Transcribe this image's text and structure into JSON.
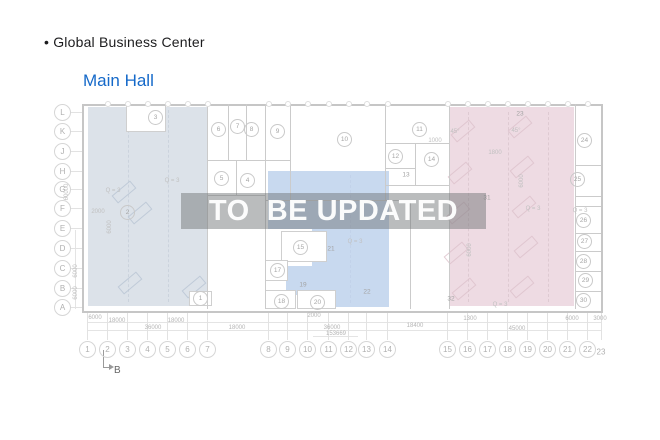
{
  "header": {
    "bullet": "•",
    "title": "Global Business Center",
    "subtitle": "Main Hall"
  },
  "watermark": {
    "text": "TO  BE UPDATED"
  },
  "colors": {
    "subtitle": "#1569c9",
    "region_left": "#dce2e9",
    "region_middle": "#c8d9ef",
    "region_right": "#eedbe3",
    "wall": "#cbcbcb",
    "annotation": "#c0c0c0"
  },
  "plan": {
    "row_labels": [
      {
        "t": "L",
        "y": 112
      },
      {
        "t": "K",
        "y": 131
      },
      {
        "t": "J",
        "y": 151
      },
      {
        "t": "H",
        "y": 171
      },
      {
        "t": "G",
        "y": 189
      },
      {
        "t": "F",
        "y": 208
      },
      {
        "t": "E",
        "y": 228
      },
      {
        "t": "D",
        "y": 248
      },
      {
        "t": "C",
        "y": 268
      },
      {
        "t": "B",
        "y": 288
      },
      {
        "t": "A",
        "y": 307
      }
    ],
    "col_labels": [
      {
        "t": "1",
        "x": 87
      },
      {
        "t": "2",
        "x": 107
      },
      {
        "t": "3",
        "x": 127
      },
      {
        "t": "4",
        "x": 147
      },
      {
        "t": "5",
        "x": 167
      },
      {
        "t": "6",
        "x": 187
      },
      {
        "t": "7",
        "x": 207
      },
      {
        "t": "8",
        "x": 268
      },
      {
        "t": "9",
        "x": 287
      },
      {
        "t": "10",
        "x": 307
      },
      {
        "t": "11",
        "x": 328
      },
      {
        "t": "12",
        "x": 348
      },
      {
        "t": "13",
        "x": 366
      },
      {
        "t": "14",
        "x": 387
      },
      {
        "t": "15",
        "x": 447
      },
      {
        "t": "16",
        "x": 467
      },
      {
        "t": "17",
        "x": 487
      },
      {
        "t": "18",
        "x": 507
      },
      {
        "t": "19",
        "x": 527
      },
      {
        "t": "20",
        "x": 547
      },
      {
        "t": "21",
        "x": 567
      },
      {
        "t": "22",
        "x": 587
      },
      {
        "t": "23",
        "x": 601,
        "y": 352,
        "plain": true
      }
    ],
    "rooms": [
      {
        "t": "3",
        "x": 155,
        "y": 117
      },
      {
        "t": "6",
        "x": 218,
        "y": 129
      },
      {
        "t": "7",
        "x": 237,
        "y": 126
      },
      {
        "t": "8",
        "x": 251,
        "y": 129
      },
      {
        "t": "9",
        "x": 277,
        "y": 131
      },
      {
        "t": "5",
        "x": 221,
        "y": 178
      },
      {
        "t": "4",
        "x": 247,
        "y": 180
      },
      {
        "t": "10",
        "x": 344,
        "y": 139
      },
      {
        "t": "11",
        "x": 419,
        "y": 129
      },
      {
        "t": "12",
        "x": 395,
        "y": 156
      },
      {
        "t": "14",
        "x": 431,
        "y": 159
      },
      {
        "t": "2",
        "x": 127,
        "y": 212
      },
      {
        "t": "1",
        "x": 200,
        "y": 298
      },
      {
        "t": "15",
        "x": 300,
        "y": 247
      },
      {
        "t": "17",
        "x": 277,
        "y": 270
      },
      {
        "t": "18",
        "x": 281,
        "y": 301
      },
      {
        "t": "20",
        "x": 317,
        "y": 302
      },
      {
        "t": "24",
        "x": 584,
        "y": 140
      },
      {
        "t": "25",
        "x": 577,
        "y": 179
      },
      {
        "t": "26",
        "x": 583,
        "y": 220
      },
      {
        "t": "27",
        "x": 584,
        "y": 241
      },
      {
        "t": "28",
        "x": 583,
        "y": 261
      },
      {
        "t": "29",
        "x": 585,
        "y": 280
      },
      {
        "t": "30",
        "x": 583,
        "y": 300
      },
      {
        "t": "13",
        "x": 406,
        "y": 175,
        "p": true
      },
      {
        "t": "19",
        "x": 303,
        "y": 285,
        "p": true
      },
      {
        "t": "21",
        "x": 331,
        "y": 249,
        "p": true
      },
      {
        "t": "22",
        "x": 367,
        "y": 292,
        "p": true
      },
      {
        "t": "23",
        "x": 520,
        "y": 114,
        "p": true
      },
      {
        "t": "31",
        "x": 487,
        "y": 198,
        "p": true
      },
      {
        "t": "32",
        "x": 451,
        "y": 299,
        "p": true
      }
    ],
    "annotations": [
      {
        "t": "Q = 3",
        "x": 113,
        "y": 191
      },
      {
        "t": "Q = 3",
        "x": 172,
        "y": 181
      },
      {
        "t": "2000",
        "x": 98,
        "y": 212
      },
      {
        "t": "6000",
        "x": 110,
        "y": 227,
        "rot": true
      },
      {
        "t": "Q = 3",
        "x": 355,
        "y": 242
      },
      {
        "t": "Q = 3",
        "x": 533,
        "y": 209
      },
      {
        "t": "Q = 3",
        "x": 580,
        "y": 211
      },
      {
        "t": "Q = 3",
        "x": 500,
        "y": 305
      },
      {
        "t": "1800",
        "x": 495,
        "y": 153
      },
      {
        "t": "1000",
        "x": 435,
        "y": 141
      },
      {
        "t": "45°",
        "x": 455,
        "y": 132
      },
      {
        "t": "45°",
        "x": 516,
        "y": 131
      },
      {
        "t": "60000",
        "x": 67,
        "y": 192,
        "rot": true
      },
      {
        "t": "6000",
        "x": 76,
        "y": 271,
        "rot": true
      },
      {
        "t": "6000",
        "x": 76,
        "y": 293,
        "rot": true
      },
      {
        "t": "6000",
        "x": 522,
        "y": 181,
        "rot": true
      },
      {
        "t": "6000",
        "x": 470,
        "y": 250,
        "rot": true
      }
    ],
    "dims": [
      {
        "t": "6000",
        "x": 95,
        "y": 318
      },
      {
        "t": "18000",
        "x": 117,
        "y": 321
      },
      {
        "t": "18000",
        "x": 176,
        "y": 321
      },
      {
        "t": "36000",
        "x": 153,
        "y": 328
      },
      {
        "t": "18000",
        "x": 237,
        "y": 328
      },
      {
        "t": "2000",
        "x": 314,
        "y": 316
      },
      {
        "t": "36000",
        "x": 332,
        "y": 328
      },
      {
        "t": "153669",
        "x": 336,
        "y": 334
      },
      {
        "t": "18400",
        "x": 415,
        "y": 326
      },
      {
        "t": "1300",
        "x": 470,
        "y": 319
      },
      {
        "t": "45000",
        "x": 517,
        "y": 329
      },
      {
        "t": "6000",
        "x": 572,
        "y": 319
      },
      {
        "t": "3000",
        "x": 600,
        "y": 319
      }
    ],
    "section_marker": {
      "t": "B"
    }
  }
}
